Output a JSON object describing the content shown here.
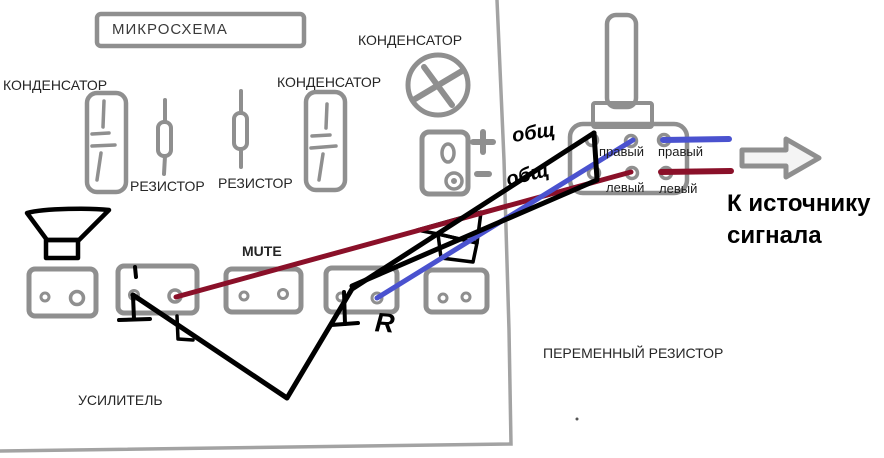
{
  "labels": {
    "microchip": "МИКРОСХЕМА",
    "capacitor_left": "КОНДЕНСАТОР",
    "capacitor_mid": "КОНДЕНСАТОР",
    "capacitor_top": "КОНДЕНСАТОР",
    "resistor_1": "РЕЗИСТОР",
    "resistor_2": "РЕЗИСТОР",
    "mute": "MUTE",
    "amplifier": "УСИЛИТЕЛЬ",
    "variable_resistor": "ПЕРЕМЕННЫЙ РЕЗИСТОР",
    "to_signal_source": "К источнику сигнала"
  },
  "potentiometer": {
    "pin_top_inner": "правый",
    "pin_top_outer": "правый",
    "pin_bottom_inner": "левый",
    "pin_bottom_outer": "левый"
  },
  "handwritten": {
    "common_1": "общ",
    "common_2": "общ",
    "right_channel_mark": "R"
  },
  "wires": {
    "right_channel_color": "#4a52cf",
    "left_channel_color": "#8a1029",
    "common_color": "#000000"
  },
  "sketch": {
    "outline_color": "#a3a3a3",
    "component_color": "#8f8f8f",
    "arrow_color": "#8f8f8f",
    "arrow_fill": "#f4f4f4"
  }
}
